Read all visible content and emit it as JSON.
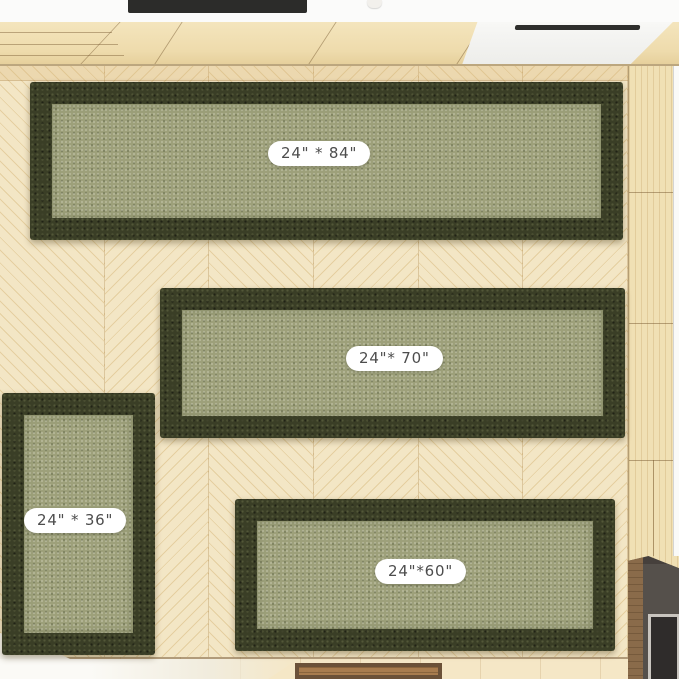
{
  "scene": {
    "kind": "product-photo",
    "subject": "four olive green bordered rugs on light chevron parquet floor, top-down room render"
  },
  "rugs": [
    {
      "name": "runner-24x84",
      "size_label": "24\" * 84\"",
      "width_in": 24,
      "length_in": 84
    },
    {
      "name": "runner-24x70",
      "size_label": "24\"* 70\"",
      "width_in": 24,
      "length_in": 70
    },
    {
      "name": "rug-24x36",
      "size_label": "24\" * 36\"",
      "width_in": 24,
      "length_in": 36
    },
    {
      "name": "runner-24x60",
      "size_label": "24\"*60\"",
      "width_in": 24,
      "length_in": 60
    }
  ],
  "colors": {
    "rug_border": "#3a3e26",
    "rug_center": "#9da07a",
    "floor_wood": "#f3e6c5",
    "wall_panel": "#f0e0b4",
    "counter_white": "#fbfbfa",
    "cooktop_dark": "#2c2c2a",
    "doormat_frame": "#6b5138",
    "doormat_wood": "#a87c4e",
    "fireplace_dark": "#46403c",
    "label_bg": "#ffffff",
    "label_text": "#4d4d4d"
  }
}
